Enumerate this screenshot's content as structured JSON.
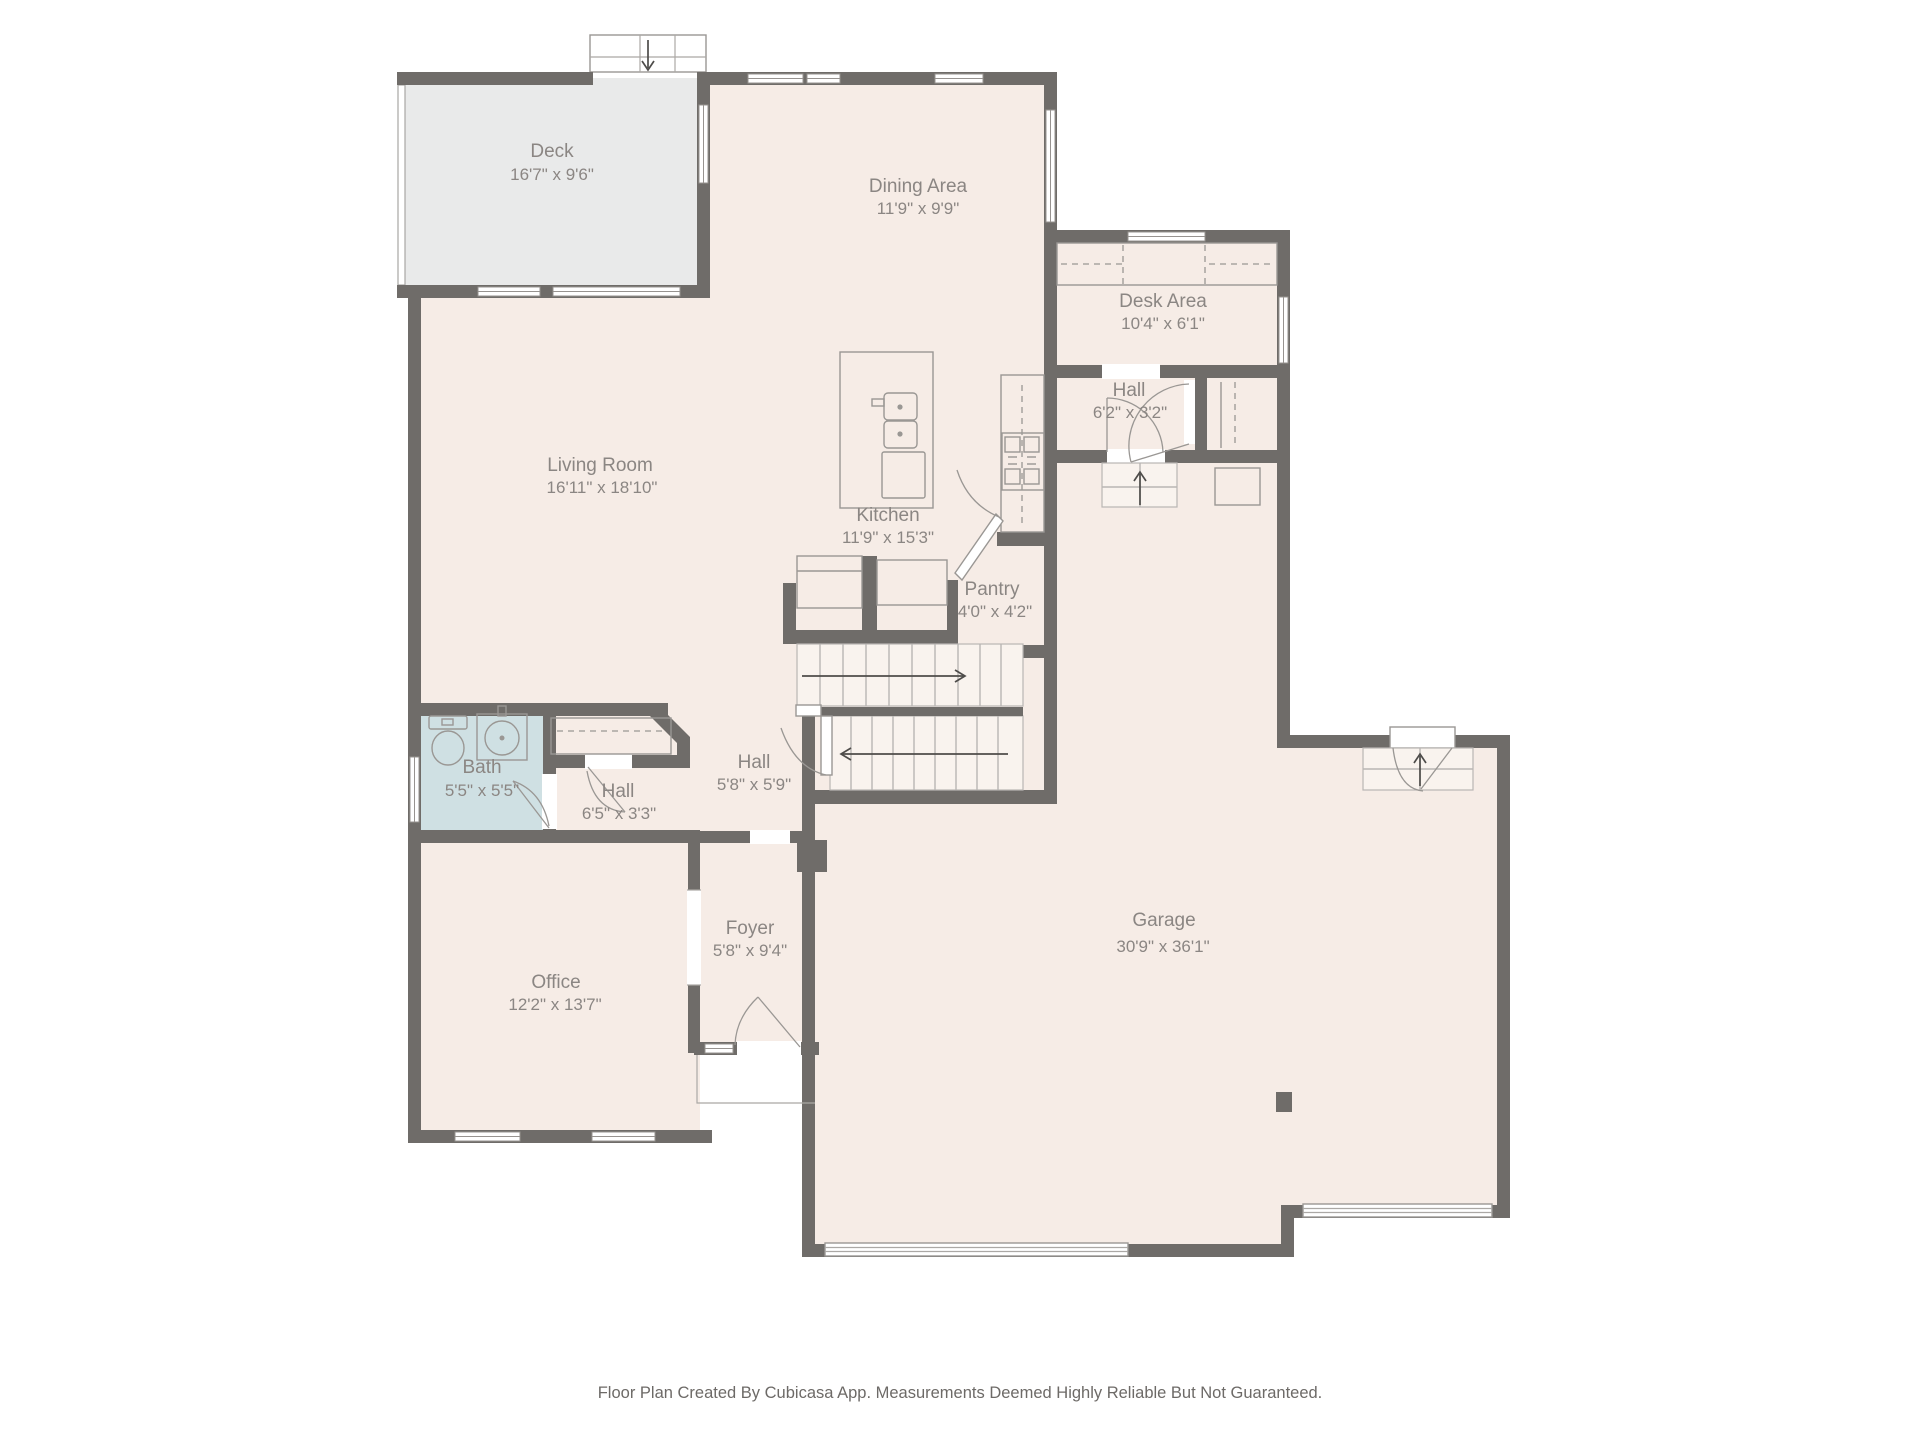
{
  "footer": {
    "text": "Floor Plan Created By Cubicasa App. Measurements Deemed Highly Reliable But Not Guaranteed."
  },
  "rooms": [
    {
      "id": "deck",
      "name": "Deck",
      "dims": "16'7\" x 9'6\""
    },
    {
      "id": "dining-area",
      "name": "Dining Area",
      "dims": "11'9\" x 9'9\""
    },
    {
      "id": "desk-area",
      "name": "Desk Area",
      "dims": "10'4\" x 6'1\""
    },
    {
      "id": "hall-upper",
      "name": "Hall",
      "dims": "6'2\" x 3'2\""
    },
    {
      "id": "living-room",
      "name": "Living Room",
      "dims": "16'11\" x 18'10\""
    },
    {
      "id": "kitchen",
      "name": "Kitchen",
      "dims": "11'9\" x 15'3\""
    },
    {
      "id": "pantry",
      "name": "Pantry",
      "dims": "4'0\" x 4'2\""
    },
    {
      "id": "bath",
      "name": "Bath",
      "dims": "5'5\" x 5'5\""
    },
    {
      "id": "hall-bath",
      "name": "Hall",
      "dims": "6'5\" x 3'3\""
    },
    {
      "id": "hall-stairs",
      "name": "Hall",
      "dims": "5'8\" x 5'9\""
    },
    {
      "id": "foyer",
      "name": "Foyer",
      "dims": "5'8\" x 9'4\""
    },
    {
      "id": "office",
      "name": "Office",
      "dims": "12'2\" x 13'7\""
    },
    {
      "id": "garage",
      "name": "Garage",
      "dims": "30'9\" x 36'1\""
    }
  ],
  "fixtures": [
    "deck-entry-steps-arrow",
    "staircase-up-arrow",
    "staircase-down-arrow",
    "garage-hall-steps-arrow",
    "garage-entry-steps-arrow",
    "kitchen-island-sink",
    "cooktop-burners",
    "refrigerator",
    "toilet",
    "bathroom-sink",
    "door-swing-arcs",
    "garage-doors",
    "closet-rails"
  ],
  "colors": {
    "background": "#ffffff",
    "room_fill": "#f6ece6",
    "deck_fill": "#e9eaea",
    "bath_fill": "#cfe0e3",
    "stair_fill": "#f9f3ee",
    "wall": "#6f6c69",
    "label_text": "#8b8683",
    "fixture_line": "#9a9794"
  }
}
